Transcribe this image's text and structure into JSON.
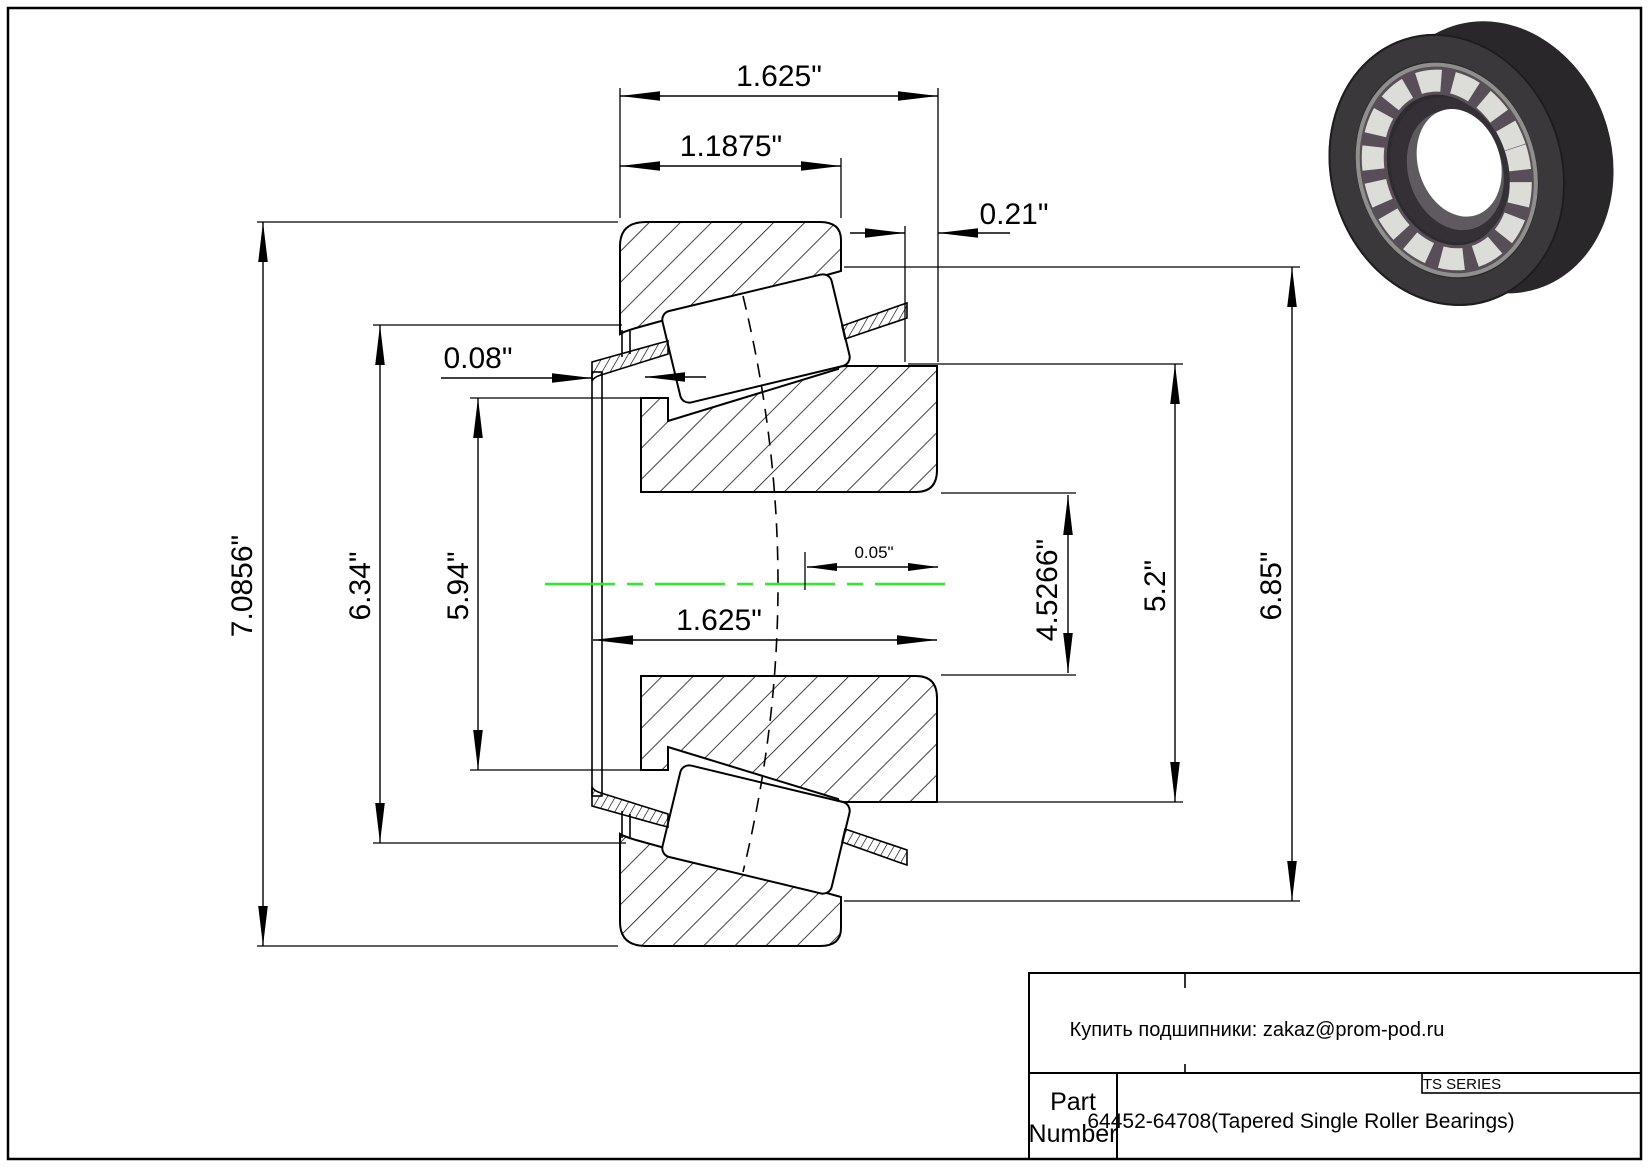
{
  "page": {
    "background": "#ffffff",
    "border_color": "#000000"
  },
  "drawing": {
    "centerline_color": "#2dea2d",
    "line_color": "#000000",
    "dims": {
      "overall_width_top": "1.625\"",
      "cup_width": "1.1875\"",
      "back_standout": "0.21\"",
      "front_standout": "0.08\"",
      "apex_offset": "0.05\"",
      "overall_width_mid": "1.625\"",
      "od": "7.0856\"",
      "dia_634": "6.34\"",
      "dia_594": "5.94\"",
      "bore_dia": "4.5266\"",
      "dia_52": "5.2\"",
      "dia_685": "6.85\""
    }
  },
  "title_block": {
    "contact_line": "Купить подшипники: zakaz@prom-pod.ru",
    "series_label": "TS SERIES",
    "part_label_line1": "Part",
    "part_label_line2": "Number",
    "part_number": "64452-64708(Tapered Single Roller Bearings)"
  },
  "illustration": {
    "name": "tapered-roller-bearing-3d-render",
    "ring_color": "#3a383b",
    "roller_color": "#dcdcd8",
    "cage_color": "#584e58"
  }
}
